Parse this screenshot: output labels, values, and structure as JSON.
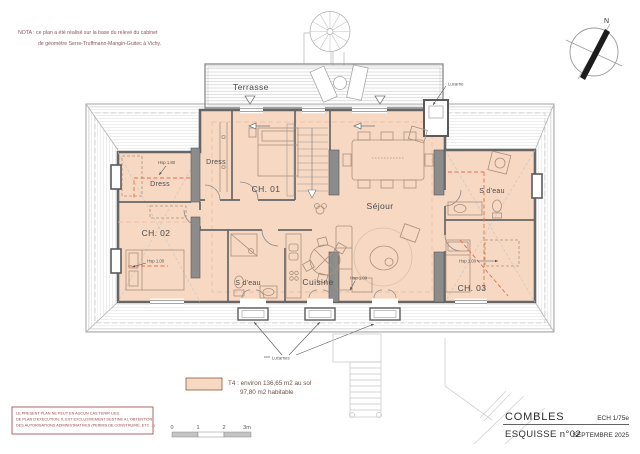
{
  "note": {
    "line1": "NOTA : ce plan a été réalisé sur la base du relevé du cabinet",
    "line2": "de géomètre Serre-Truffmann-Mangin-Guitec à Vichy."
  },
  "compass": {
    "north_label": "N"
  },
  "plan": {
    "terrace_label": "Terrasse",
    "rooms": {
      "dress_left": "Dress",
      "dress_center": "Dress",
      "ch01": "CH. 01",
      "ch02": "CH. 02",
      "ch03": "CH. 03",
      "sejour": "Séjour",
      "sdeau_center": "S d'eau",
      "sdeau_right": "S d'eau",
      "cuisine": "Cuisine"
    },
    "annotations": {
      "hsp180": "Hsp 1.80",
      "hsp100": "Hsp 1.00",
      "lucarne": "Lucarne",
      "lucarnes": "Lucarnes"
    }
  },
  "legend": {
    "line1": "T4 : environ 136,65 m2 au sol",
    "line2": "97,80 m2 habitable"
  },
  "scalebar": {
    "t0": "0",
    "t1": "1",
    "t2": "2",
    "t3": "3m"
  },
  "disclaimer": {
    "line1": "LE PRESENT PLAN NE PEUT EN AUCUN CAS TENIR LIEU",
    "line2": "DE PLAN D'EXECUTION. IL EST EXCLUSIVEMENT DESTINE A L'OBTENTION",
    "line3": "DES AUTORISATIONS ADMINISTRATIVES (PERMIS DE CONSTRUIRE, ETC ...)"
  },
  "titleblock": {
    "title": "COMBLES",
    "scale": "ECH 1/75e",
    "sketch": "ESQUISSE n°02",
    "date": "SEPTEMBRE 2025"
  },
  "colors": {
    "floor_fill": "#f7d8c3",
    "wall": "#666666",
    "red_dash": "#e0714d"
  }
}
